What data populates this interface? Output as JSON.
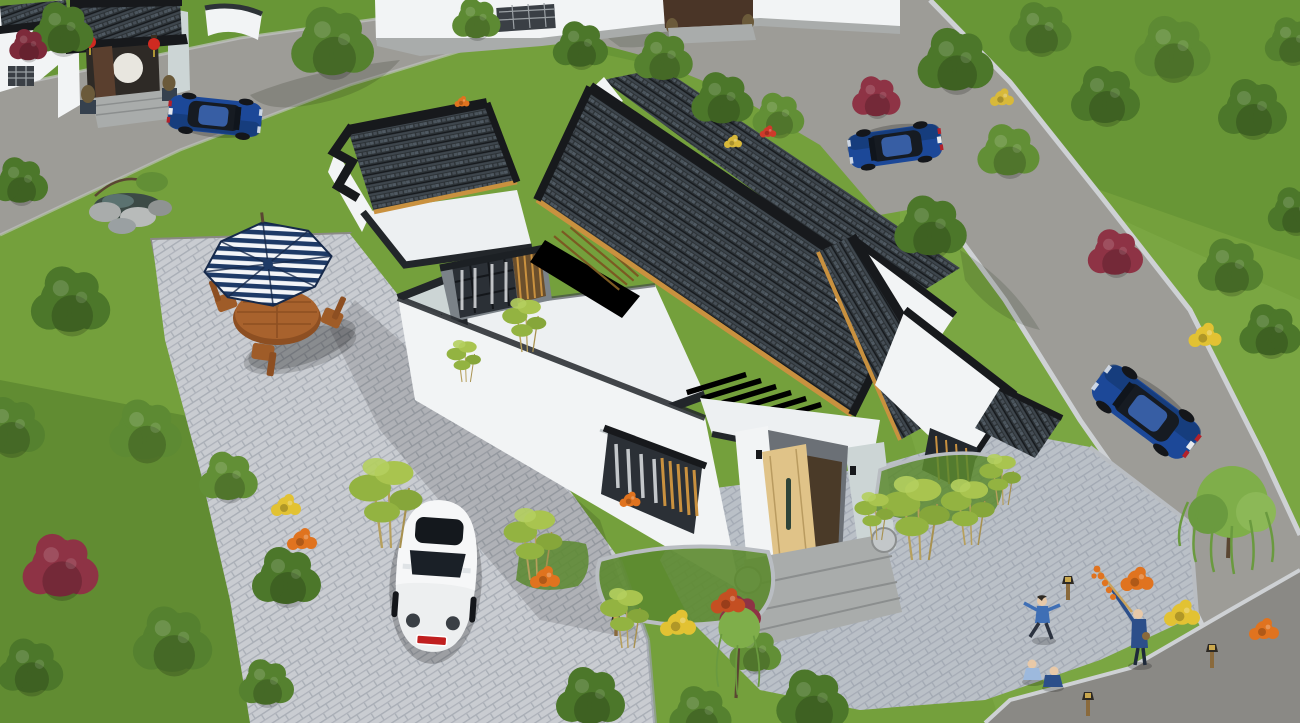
{
  "meta": {
    "title": "Aerial 3D architectural rendering of a Chinese-style single-storey courtyard residence",
    "render_type": "isometric aerial 3D visualization",
    "visible_text": "none"
  },
  "palette": {
    "grass": "#74a03c",
    "grass_dark": "#5c8a2f",
    "grass_light": "#87b24c",
    "road": "#9d9c97",
    "road_dark": "#8a8985",
    "curb": "#ced1d4",
    "paver": "#c9ccd1",
    "paver_line": "#a9aeb6",
    "plaza_tint": "#8f9aaa",
    "roof_tile": "#2d3337",
    "roof_tile_light": "#59646e",
    "roof_trim": "#17191c",
    "eave_wood": "#c9913f",
    "wall": "#f2f4f5",
    "wall_shade": "#ccd5d5",
    "flat_roof": "#edf0f2",
    "door_wood": "#e0c388",
    "umbrella_navy": "#1e3a66",
    "umbrella_white": "#f3f5f8",
    "table_wood": "#a8622d",
    "car_blue": "#1c4898",
    "car_white": "#edeff0",
    "lantern_red": "#cf2a21",
    "flower_orange": "#e0731f",
    "flower_yellow": "#e2c233",
    "bush_red": "#8e3345",
    "tree_green": "#4c772a",
    "willow_green": "#7fae4a",
    "bamboo_green": "#93b341",
    "stone": "#a9acab",
    "people_blue": "#3f6fb5",
    "people_blue_dark": "#2c4f8a"
  },
  "scene": {
    "main_house": "white-walled courtyard house with dark grey tiled pitched roofs, flat white roof terraces, timber pergola beams, lattice courtyard screens and a light-wood entrance door flanked by drum stones",
    "entrance_gate": "traditional gate house at upper left with grey tile roof, two red lanterns and stone lions",
    "front_yard": "stone-paved driveway with parked white Beetle and a patio with navy striped umbrella, wooden table and four chairs",
    "side_plaza": "herringbone paved plaza at lower right with children playing and an adult holding a candied-haw stick",
    "vehicles": [
      "blue sedan beside the gate",
      "blue sedan on the upper road",
      "blue sedan on the right-hand road",
      "white Beetle in the driveway"
    ],
    "landscape": "lawns, deciduous trees, red-leaf shrubs, bamboo clumps, orange and yellow flower beds, rock garden with pond, weeping willow"
  }
}
